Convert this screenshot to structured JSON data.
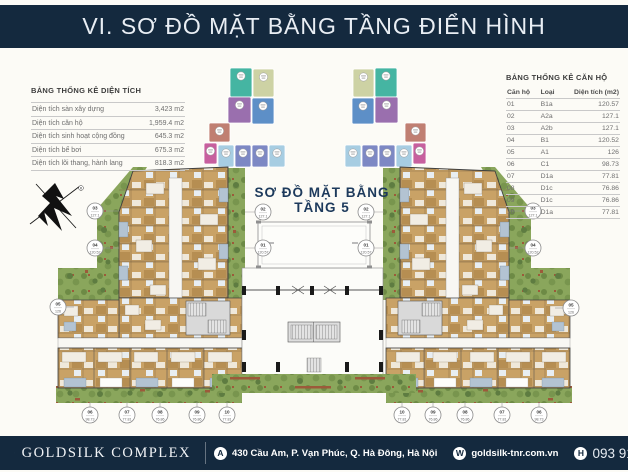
{
  "header": {
    "title": "VI. SƠ ĐỒ MẶT BẰNG TẦNG ĐIỂN HÌNH"
  },
  "area_table": {
    "title": "BẢNG THỐNG KÊ DIỆN TÍCH",
    "rows": [
      {
        "label": "Diện tích sàn xây dựng",
        "value": "3,423 m2"
      },
      {
        "label": "Diện tích căn hộ",
        "value": "1,959.4 m2"
      },
      {
        "label": "Diện tích sinh hoạt cộng đồng",
        "value": "645.3 m2"
      },
      {
        "label": "Diện tích bể bơi",
        "value": "675.3 m2"
      },
      {
        "label": "Diện tích lõi thang, hành lang",
        "value": "818.3 m2"
      }
    ]
  },
  "unit_table": {
    "title": "BẢNG THỐNG KÊ CĂN HỘ",
    "columns": [
      "Căn hộ",
      "Loại",
      "Diện tích (m2)"
    ],
    "rows": [
      [
        "01",
        "B1a",
        "120.57"
      ],
      [
        "02",
        "A2a",
        "127.1"
      ],
      [
        "03",
        "A2b",
        "127.1"
      ],
      [
        "04",
        "B1",
        "120.52"
      ],
      [
        "05",
        "A1",
        "126"
      ],
      [
        "06",
        "C1",
        "98.73"
      ],
      [
        "07",
        "D1a",
        "77.81"
      ],
      [
        "08",
        "D1c",
        "76.86"
      ],
      [
        "09",
        "D1c",
        "76.86"
      ],
      [
        "10",
        "D1a",
        "77.81"
      ]
    ]
  },
  "plan": {
    "title_line1": "SƠ ĐỒ MẶT BẰNG",
    "title_line2": "TẦNG 5"
  },
  "mini_diagrams": {
    "palette": {
      "teal": "#45b5a2",
      "khaki": "#cdd2a4",
      "purple": "#9a6fae",
      "blue": "#5d8fc7",
      "salmon": "#c07f72",
      "magenta": "#c75f9e",
      "lightblue": "#a7cde2",
      "periwinkle": "#7d88c4"
    }
  },
  "footer": {
    "brand": "GOLDSILK COMPLEX",
    "address_icon": "A",
    "address": "430 Cầu Am, P. Vạn Phúc, Q. Hà Đông, Hà Nội",
    "website_icon": "W",
    "website": "goldsilk-tnr.com.vn",
    "hotline_icon": "H",
    "hotline": "093 915 8868"
  },
  "colors": {
    "navy": "#14293e",
    "title_text": "#e9eef4",
    "plan_title": "#1d3a5c",
    "green": "#8aa65c",
    "green_dark": "#5e7c41",
    "tan": "#c9a266",
    "table_line": "#c9c9c9",
    "text_gray": "#6e6e6e"
  }
}
